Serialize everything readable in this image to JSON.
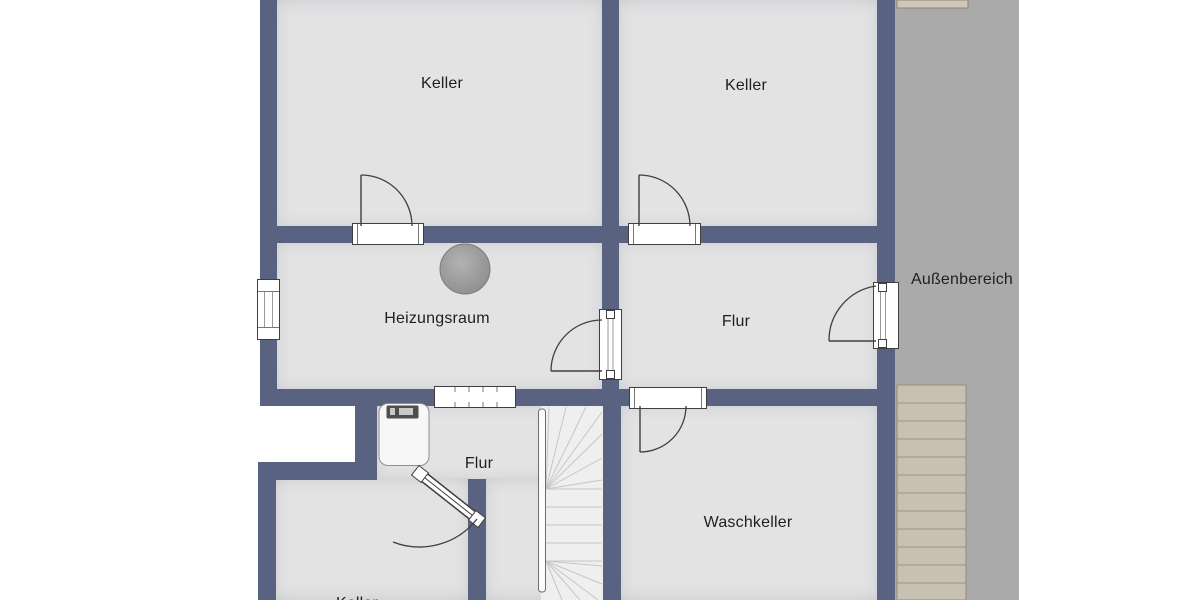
{
  "plan": {
    "kind": "basement-floorplan",
    "language": "de"
  },
  "rooms": [
    {
      "id": "keller-left",
      "label": "Keller"
    },
    {
      "id": "keller-right",
      "label": "Keller"
    },
    {
      "id": "heizungsraum",
      "label": "Heizungsraum"
    },
    {
      "id": "flur-upper",
      "label": "Flur"
    },
    {
      "id": "aussenbereich",
      "label": "Außenbereich"
    },
    {
      "id": "flur-lower",
      "label": "Flur"
    },
    {
      "id": "waschkeller",
      "label": "Waschkeller"
    },
    {
      "id": "keller-bottom-cut",
      "label": "Keller"
    }
  ],
  "fixtures": {
    "boiler": "heating-boiler",
    "washbasin": "washbasin-with-tap",
    "interior_stairs": "winder-staircase",
    "exterior_stairs": "outdoor-staircase"
  },
  "colors": {
    "wall": "#5a6281",
    "floor": "#e3e3e4",
    "outdoor_area": "#aaaaaa",
    "exterior_stairs": "#c8c0b1",
    "interior_stairs": "#efefef",
    "door_lines": "#3f3f3f",
    "label_text": "#1f1f1f",
    "background": "#ffffff"
  }
}
